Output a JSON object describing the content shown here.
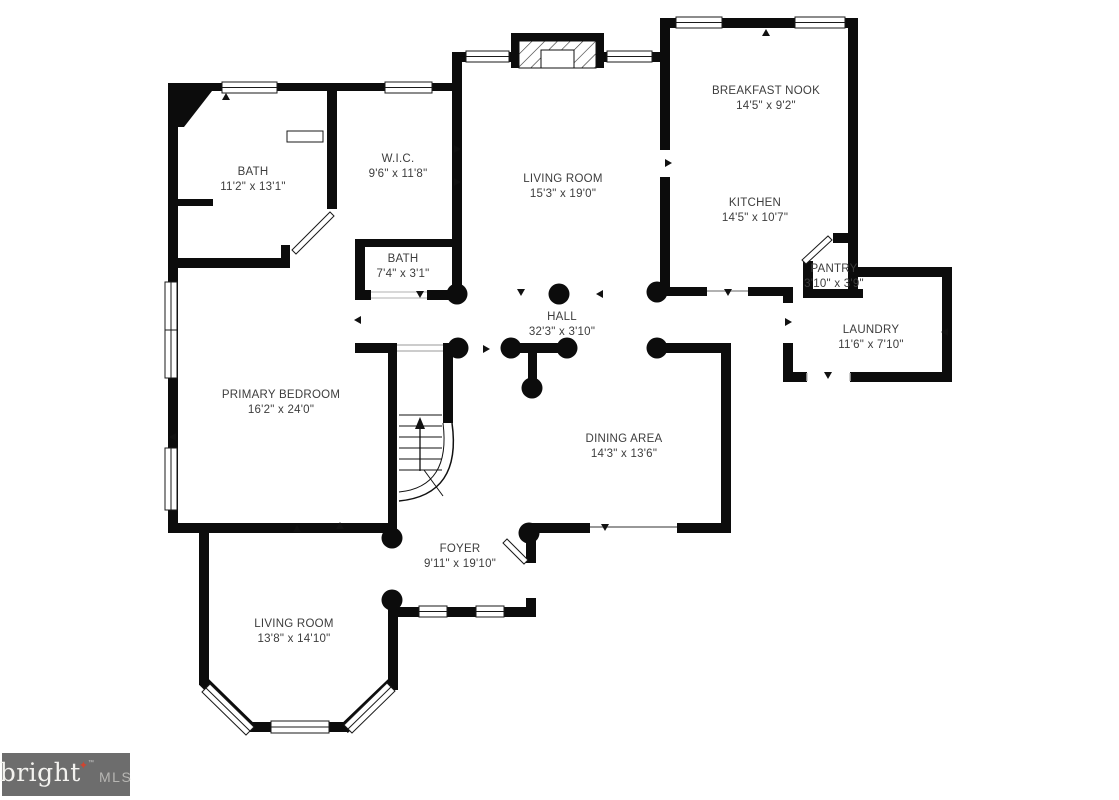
{
  "rooms": [
    {
      "id": "bath-primary",
      "name": "BATH",
      "dims": "11'2\" x 13'1\""
    },
    {
      "id": "wic",
      "name": "W.I.C.",
      "dims": "9'6\" x 11'8\""
    },
    {
      "id": "living-room-upper",
      "name": "LIVING ROOM",
      "dims": "15'3\" x 19'0\""
    },
    {
      "id": "breakfast-nook",
      "name": "BREAKFAST NOOK",
      "dims": "14'5\" x 9'2\""
    },
    {
      "id": "kitchen",
      "name": "KITCHEN",
      "dims": "14'5\" x 10'7\""
    },
    {
      "id": "pantry",
      "name": "PANTRY",
      "dims": "3'10\" x 3'9\""
    },
    {
      "id": "bath-hall",
      "name": "BATH",
      "dims": "7'4\" x 3'1\""
    },
    {
      "id": "hall",
      "name": "HALL",
      "dims": "32'3\" x 3'10\""
    },
    {
      "id": "laundry",
      "name": "LAUNDRY",
      "dims": "11'6\" x 7'10\""
    },
    {
      "id": "primary-bedroom",
      "name": "PRIMARY BEDROOM",
      "dims": "16'2\" x 24'0\""
    },
    {
      "id": "dining-area",
      "name": "DINING AREA",
      "dims": "14'3\" x 13'6\""
    },
    {
      "id": "foyer",
      "name": "FOYER",
      "dims": "9'11\" x 19'10\""
    },
    {
      "id": "living-room-lower",
      "name": "LIVING ROOM",
      "dims": "13'8\" x 14'10\""
    }
  ],
  "logo": {
    "brand": "bright",
    "star": "✦",
    "tm": "™",
    "suffix": "MLS"
  },
  "colors": {
    "wall": "#0c0c0c",
    "background": "#ffffff",
    "label": "#3d3d3d",
    "logo_bg": "#6d6d6d",
    "logo_star": "#cf4430"
  }
}
